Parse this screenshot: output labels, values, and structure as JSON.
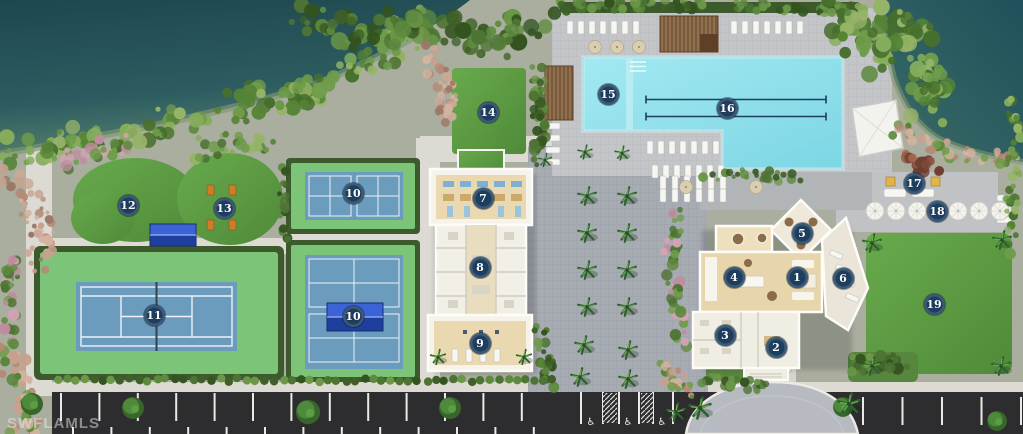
{
  "watermark": "SWFLAMLS",
  "plan": {
    "type": "community-amenity-site-plan",
    "features": [
      "lake",
      "tennis-court",
      "pickleball-courts",
      "event-lawns",
      "amenity-building",
      "clubhouse",
      "resort-pool",
      "lap-lanes",
      "fire-pit-terrace",
      "umbrella-terrace",
      "great-lawn",
      "parking-lot",
      "accessible-parking",
      "roundabout-drive"
    ]
  },
  "markers": [
    {
      "label": "1",
      "x": 797,
      "y": 277
    },
    {
      "label": "2",
      "x": 776,
      "y": 347
    },
    {
      "label": "3",
      "x": 725,
      "y": 335
    },
    {
      "label": "4",
      "x": 734,
      "y": 277
    },
    {
      "label": "5",
      "x": 802,
      "y": 233
    },
    {
      "label": "6",
      "x": 843,
      "y": 278
    },
    {
      "label": "7",
      "x": 483,
      "y": 198
    },
    {
      "label": "8",
      "x": 480,
      "y": 267
    },
    {
      "label": "9",
      "x": 480,
      "y": 343
    },
    {
      "label": "10",
      "x": 353,
      "y": 193
    },
    {
      "label": "10",
      "x": 353,
      "y": 316
    },
    {
      "label": "11",
      "x": 154,
      "y": 315
    },
    {
      "label": "12",
      "x": 128,
      "y": 205
    },
    {
      "label": "13",
      "x": 224,
      "y": 208
    },
    {
      "label": "14",
      "x": 488,
      "y": 112
    },
    {
      "label": "15",
      "x": 608,
      "y": 94
    },
    {
      "label": "16",
      "x": 727,
      "y": 108
    },
    {
      "label": "17",
      "x": 914,
      "y": 183
    },
    {
      "label": "18",
      "x": 937,
      "y": 211
    },
    {
      "label": "19",
      "x": 934,
      "y": 304
    }
  ],
  "accessible_parking": {
    "symbol": "♿",
    "spaces": [
      {
        "x": 591,
        "y": 421
      },
      {
        "x": 628,
        "y": 421
      },
      {
        "x": 662,
        "y": 421
      }
    ]
  },
  "colors": {
    "lake_deep": "#24525b",
    "lake_shallow": "#4f7d72",
    "shore_rim": "#7e9671",
    "lawn": "#5f9e45",
    "lawn_dark": "#4b8236",
    "court_surround": "#7cc478",
    "court_blue": "#6b9bbd",
    "court_line": "#edf3f7",
    "pool_water": "#8ce0eb",
    "pool_lane": "#1d3e5f",
    "deck": "#c3c5c8",
    "plaza": "#a7abb2",
    "path": "#dcdad3",
    "asphalt": "#2d2d2f",
    "stall_line": "#e9e9e6",
    "hedge": "#3c5a2c",
    "building_wall": "#f6f3ea",
    "floor_tan": "#e7d5ab",
    "terrace_stone": "#eae5d8",
    "wood": "#7b5a39",
    "tent_blue": "#2e54c0",
    "marker_bg": "#1d3e5f",
    "marker_text": "#ffffff"
  }
}
